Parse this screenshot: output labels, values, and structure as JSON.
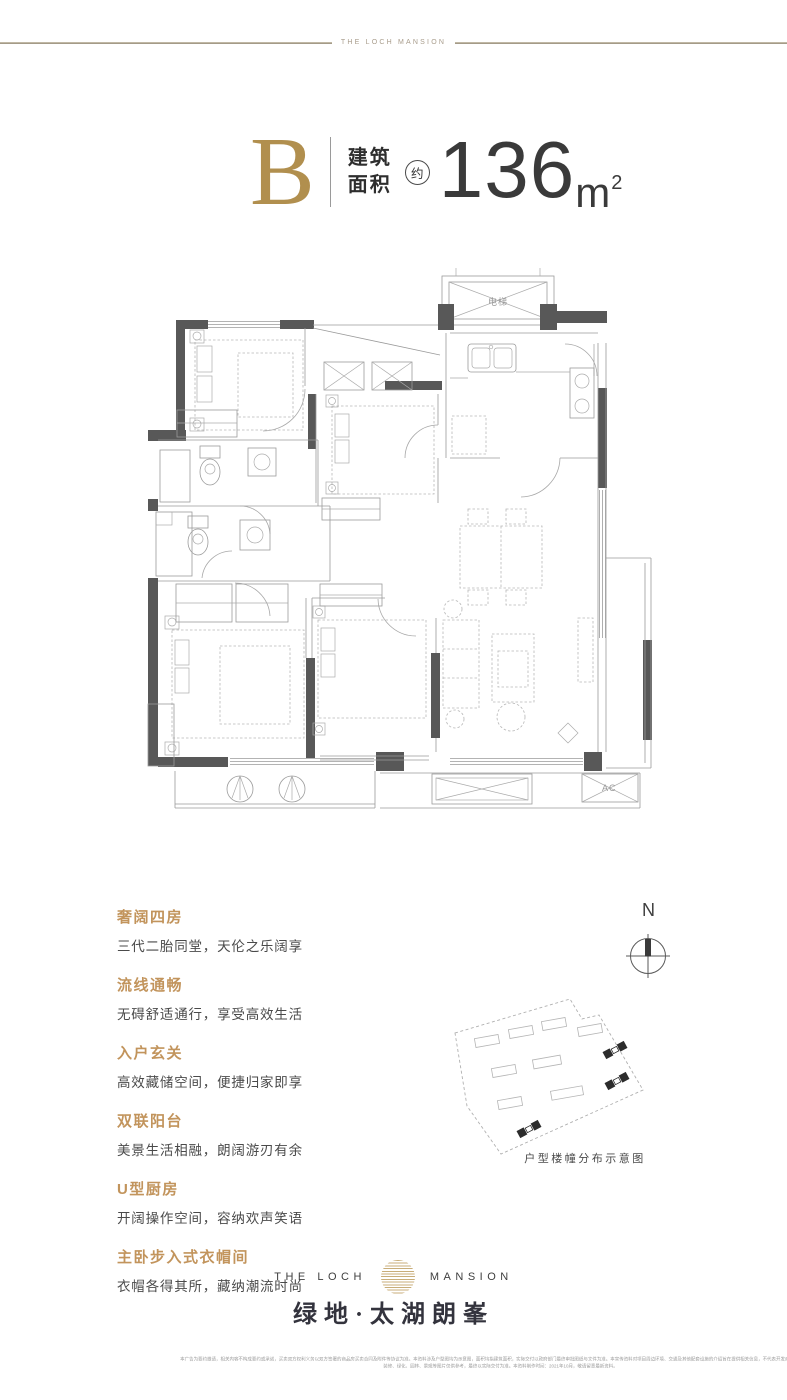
{
  "top_bar": {
    "brand": "THE LOCH MANSION"
  },
  "header": {
    "unit": "B",
    "area_label_line1": "建筑",
    "area_label_line2": "面积",
    "approx": "约",
    "area_value": "136",
    "area_unit": "m",
    "area_unit_sup": "2"
  },
  "floor_plan": {
    "elevator_label": "电梯",
    "ac_label": "AC"
  },
  "features": [
    {
      "title": "奢阔四房",
      "desc": "三代二胎同堂，天伦之乐阔享"
    },
    {
      "title": "流线通畅",
      "desc": "无碍舒适通行，享受高效生活"
    },
    {
      "title": "入户玄关",
      "desc": "高效藏储空间，便捷归家即享"
    },
    {
      "title": "双联阳台",
      "desc": "美景生活相融，朗阔游刃有余"
    },
    {
      "title": "U型厨房",
      "desc": "开阔操作空间，容纳欢声笑语"
    },
    {
      "title": "主卧步入式衣帽间",
      "desc": "衣帽各得其所，藏纳潮流时尚"
    }
  ],
  "compass": {
    "north": "N"
  },
  "site_map": {
    "caption": "户型楼幢分布示意图"
  },
  "footer": {
    "logo_left": "THE LOCH",
    "logo_right": "MANSION",
    "brand_cn": "绿地·太湖朗峯",
    "disclaimer_line1": "本广告为要约邀请，相关内容不构成要约或承诺，买卖双方权利义务以双方签署的商品房买卖合同及附件等协议为准。本资料涉及户型图均为示意图，面积均指建筑面积，实际交付以政府部门最终审批图纸与文件为准。本宣传资料对项目周边环境、交通及其他配套设施的介绍旨在提供相关信息，不代表开发商对此作出承诺。",
    "disclaimer_line2": "装修、绿化、园林、景观等图片仅供参考，最终以实际交付为准。本资料制作时间：2021年10月，敬请留意最新资料。"
  },
  "colors": {
    "accent_gold": "#b18f4e",
    "feature_title_gold": "#c2945c",
    "wall_dark": "#585858",
    "line_beige": "#b0a693",
    "text_dark": "#3a3a3a"
  }
}
